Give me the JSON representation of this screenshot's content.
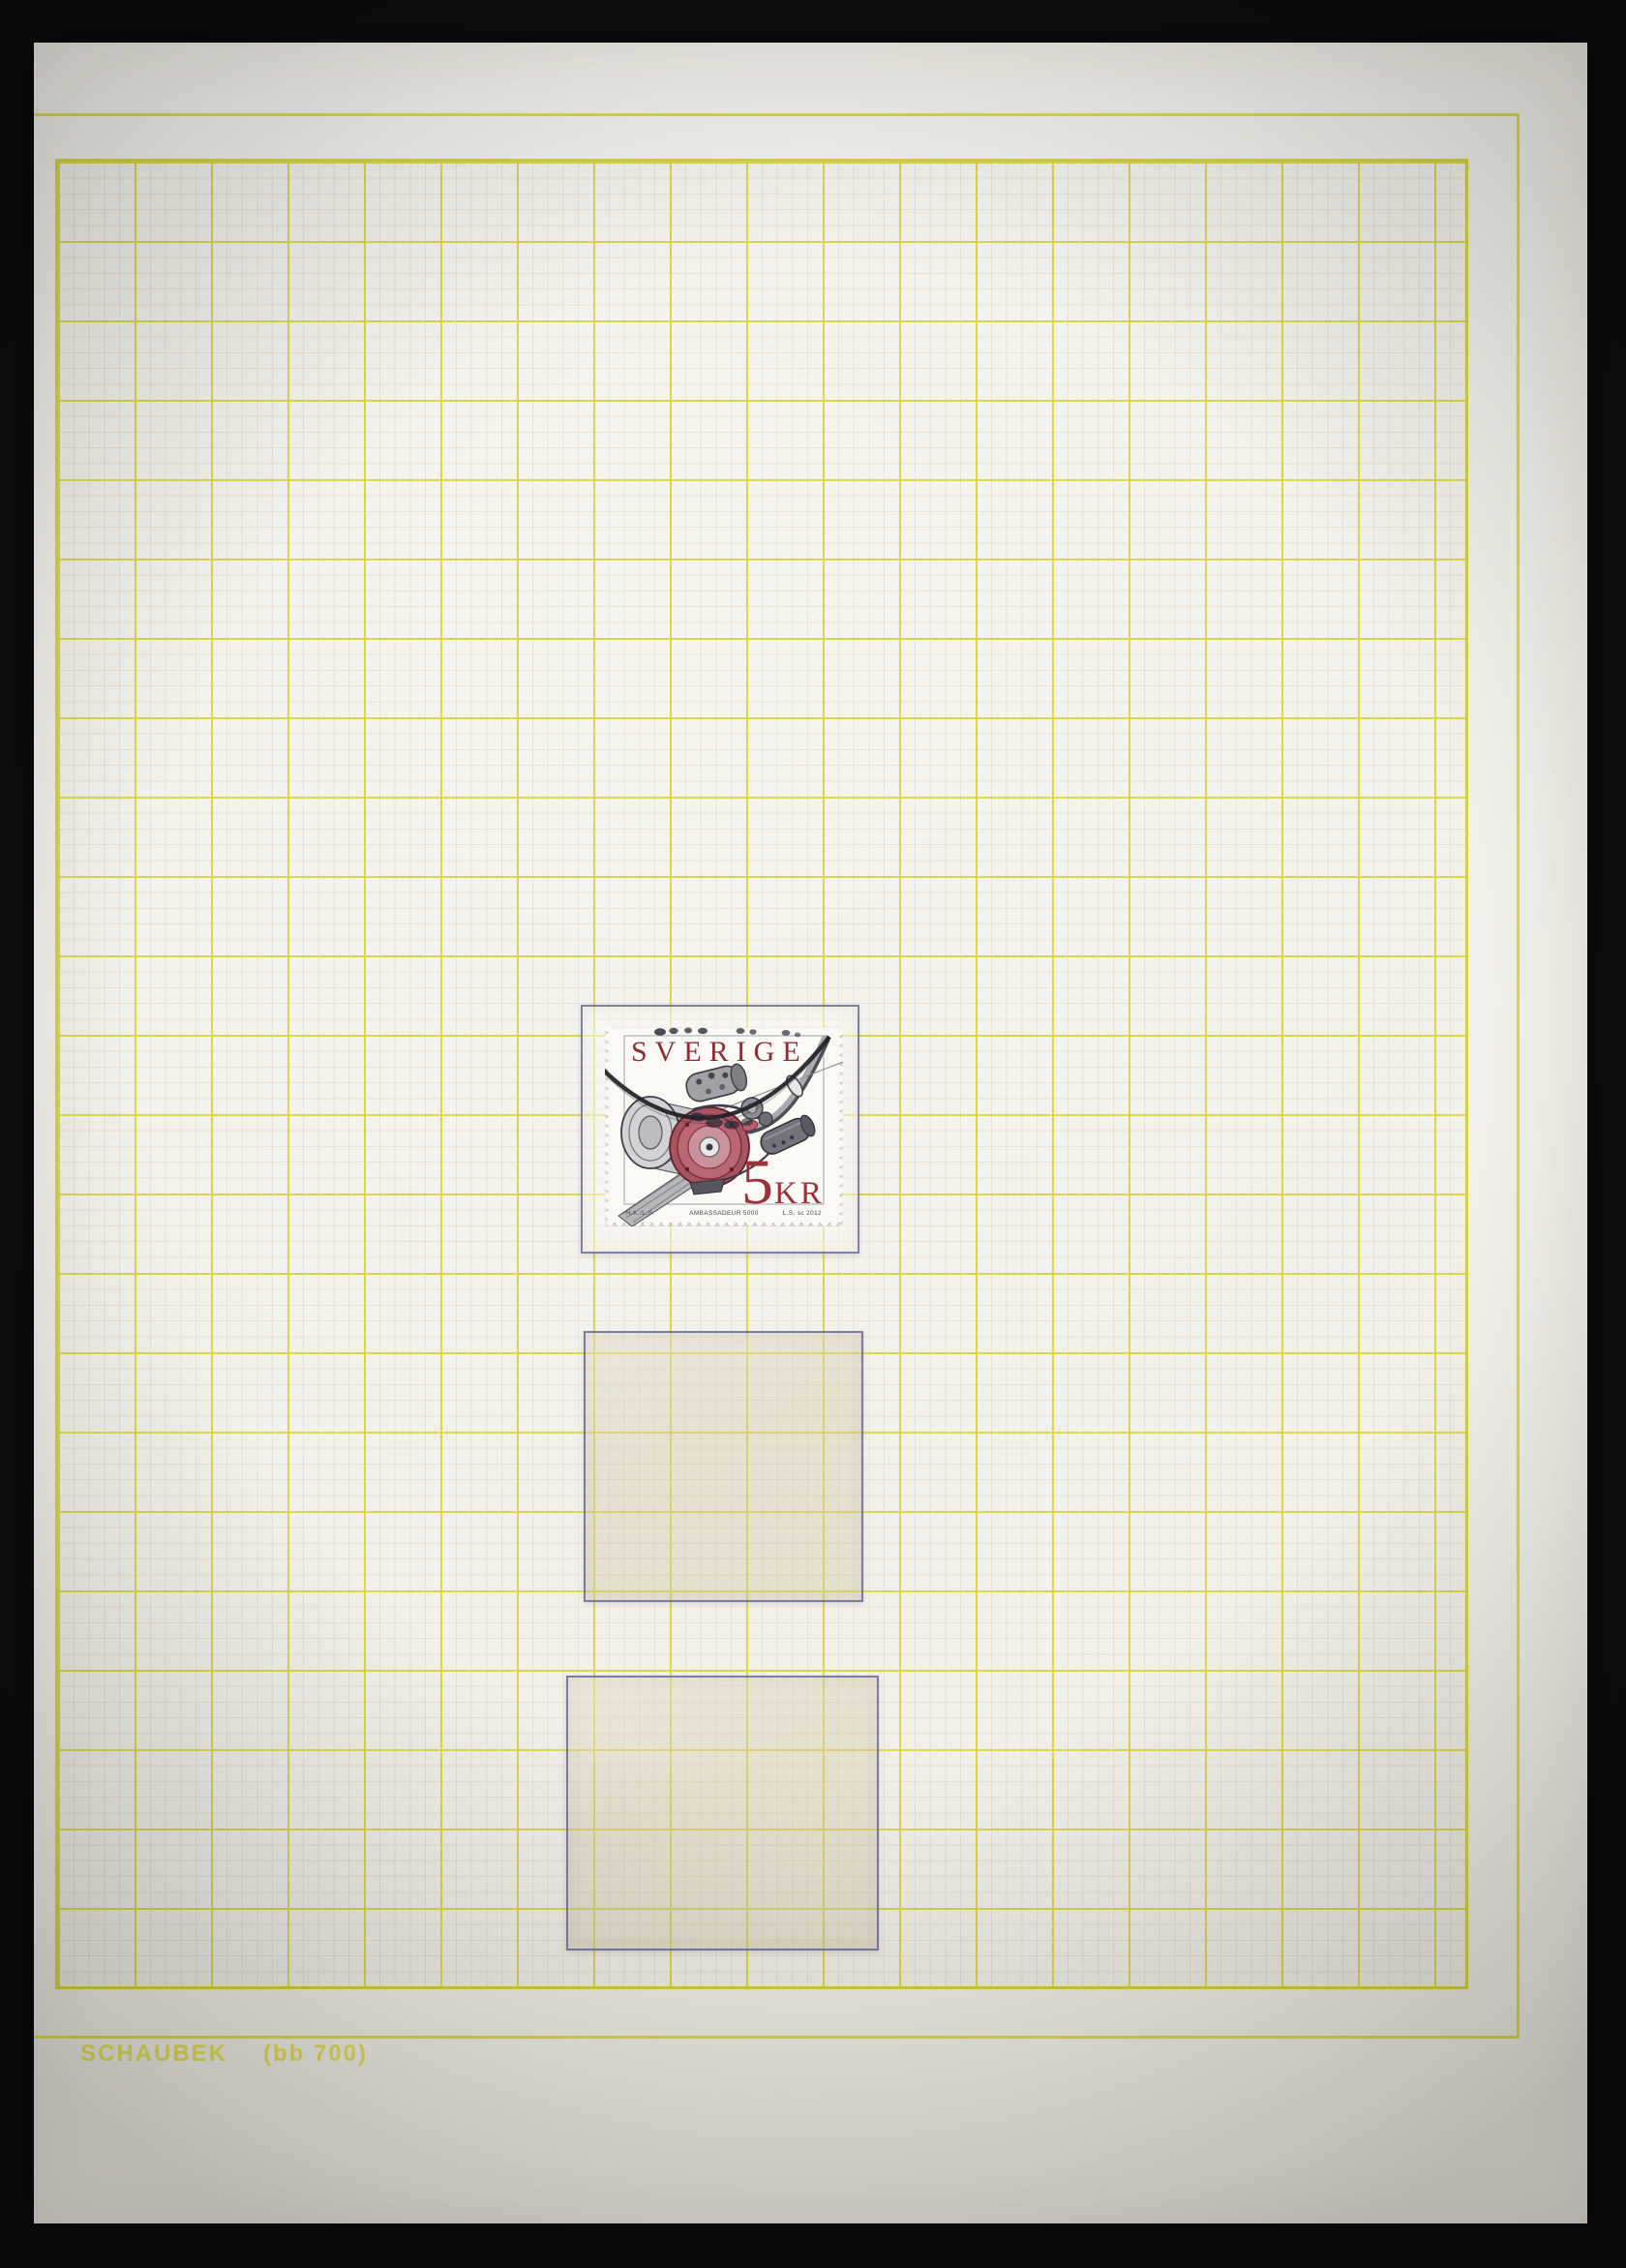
{
  "photo": {
    "description": "Photograph of a Schaubek stamp album quadrille page on a black background",
    "background_color": "#0e0e0f",
    "paper_color": "#f1efe8",
    "grid_line_color": "#dcd752",
    "mount_border_color": "#6a6a9d"
  },
  "page": {
    "publisher": "SCHAUBEK",
    "page_code": "(bb 700)"
  },
  "mounts": [
    {
      "label": "mount with stamp",
      "state": "occupied"
    },
    {
      "label": "empty mount middle",
      "state": "empty"
    },
    {
      "label": "empty mount bottom",
      "state": "empty"
    }
  ],
  "stamp": {
    "country": "SVERIGE",
    "value": "5",
    "currency": "KR",
    "engraver_left": "H.K./L.S.",
    "subject": "AMBASSADEUR 5000",
    "credit_right": "L.S. sc 2012",
    "ink_red": "#8d2c36",
    "cancel_color": "#202027",
    "condition": "used, black arc postmark"
  }
}
